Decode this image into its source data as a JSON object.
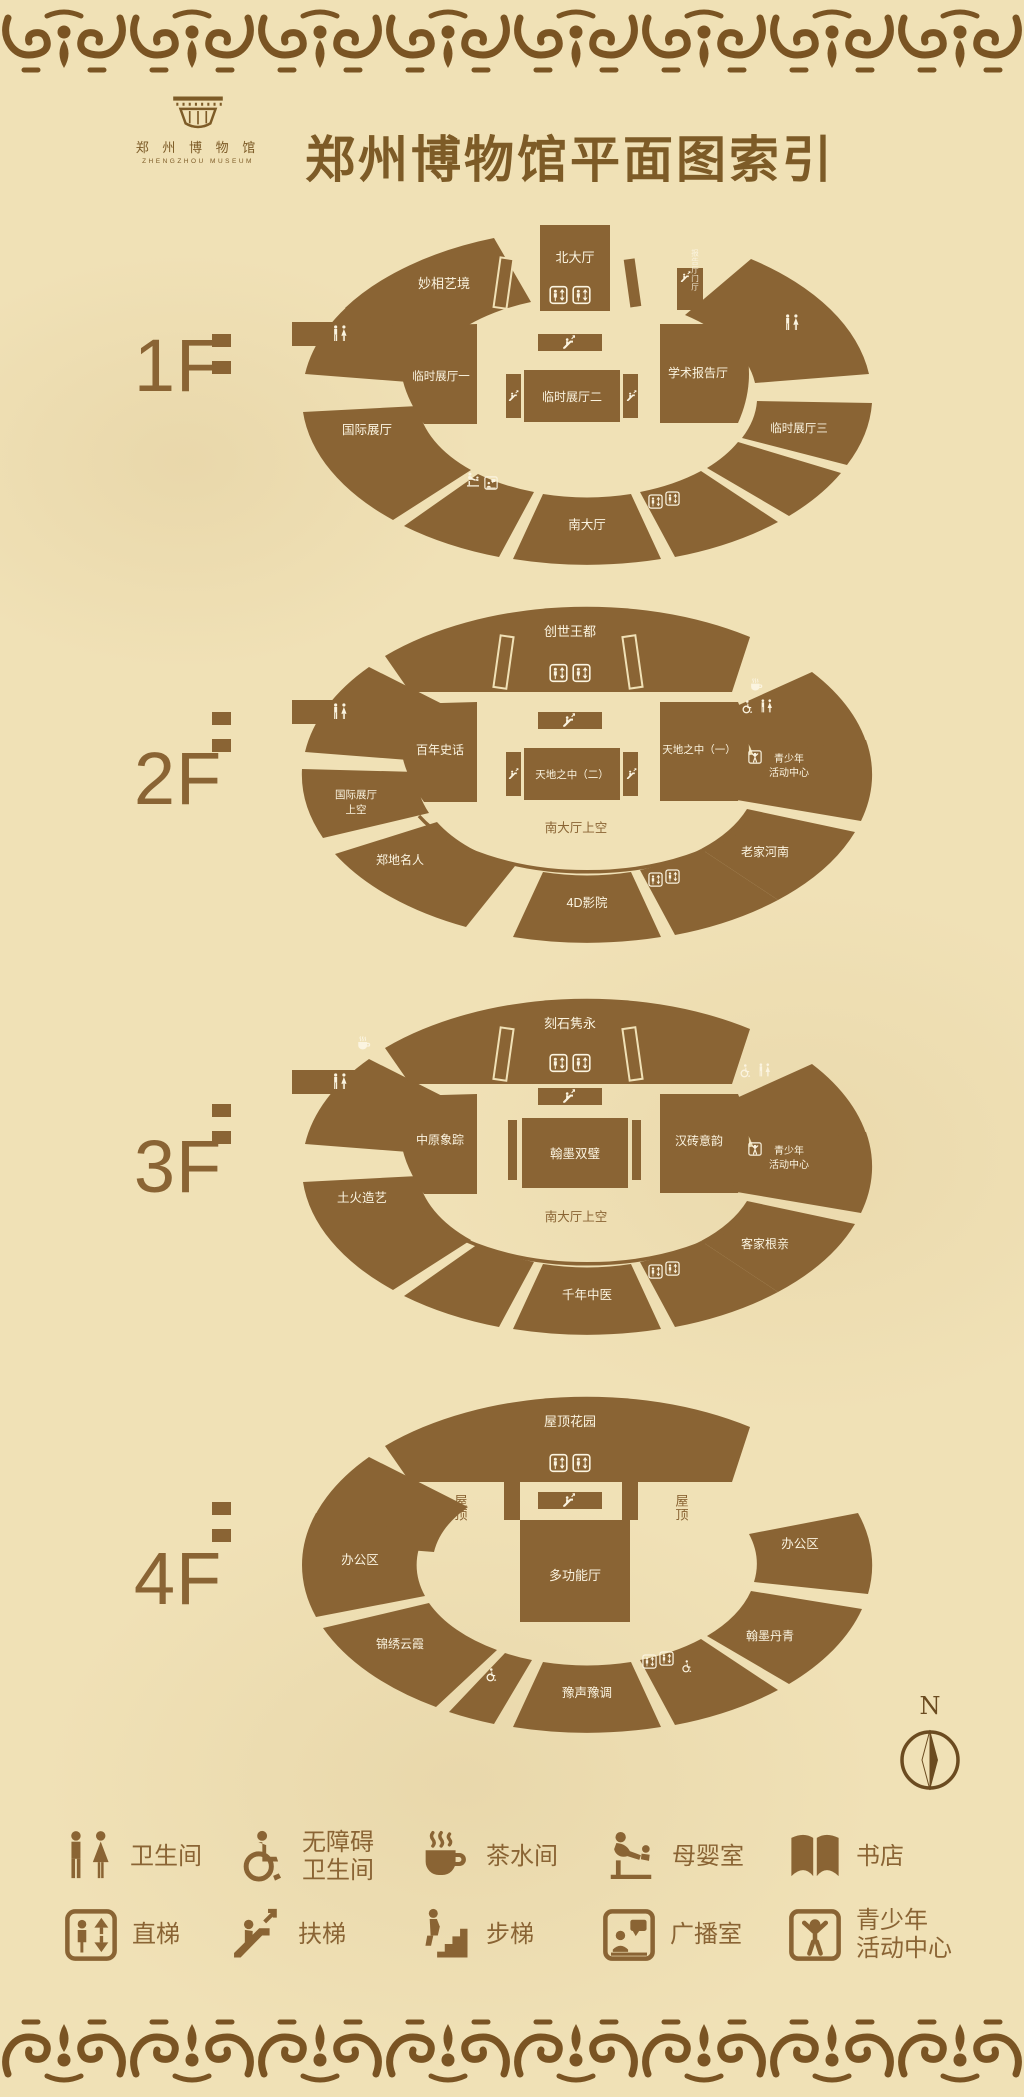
{
  "header": {
    "title": "郑州博物馆平面图索引",
    "logo_cn": "郑 州 博 物 馆",
    "logo_en": "ZHENGZHOU MUSEUM"
  },
  "colors": {
    "paper": "#f0e1b6",
    "plan_brown": "#8a6434",
    "border_brown": "#7a5423",
    "label_cream": "#fbf4e0"
  },
  "floors": [
    {
      "label": "1F",
      "rooms": {
        "top_left": "妙相艺境",
        "north_hall": "北大厅",
        "foyer": "报告厅门厅",
        "lecture": "学术报告厅",
        "temp1": "临时展厅一",
        "temp2": "临时展厅二",
        "temp3": "临时展厅三",
        "intl": "国际展厅",
        "south_hall": "南大厅"
      }
    },
    {
      "label": "2F",
      "rooms": {
        "top": "创世王都",
        "intl_up1": "国际展厅",
        "intl_up2": "上空",
        "century": "百年史话",
        "heaven2": "天地之中（二）",
        "heaven1": "天地之中（一）",
        "youth1": "青少年",
        "youth2": "活动中心",
        "zheng": "郑地名人",
        "south_up": "南大厅上空",
        "laojia": "老家河南",
        "cinema": "4D影院"
      }
    },
    {
      "label": "3F",
      "rooms": {
        "top": "刻石隽永",
        "elephant": "中原象踪",
        "hanmo": "翰墨双璧",
        "hanzhuan": "汉砖意韵",
        "youth1": "青少年",
        "youth2": "活动中心",
        "tuhuo": "土火造艺",
        "south_up": "南大厅上空",
        "kejia": "客家根亲",
        "zhongyi": "千年中医"
      }
    },
    {
      "label": "4F",
      "rooms": {
        "top": "屋顶花园",
        "office_left": "办公区",
        "roof_left": "屋顶",
        "multi": "多功能厅",
        "roof_right": "屋顶",
        "office_right": "办公区",
        "jinxiu": "锦绣云霞",
        "yusheng": "豫声豫调",
        "hanmo": "翰墨丹青"
      }
    }
  ],
  "legend": {
    "row1": [
      {
        "icon": "restroom-icon",
        "label1": "卫生间",
        "label2": ""
      },
      {
        "icon": "accessible-restroom-icon",
        "label1": "无障碍",
        "label2": "卫生间"
      },
      {
        "icon": "tea-room-icon",
        "label1": "茶水间",
        "label2": ""
      },
      {
        "icon": "nursing-room-icon",
        "label1": "母婴室",
        "label2": ""
      },
      {
        "icon": "bookstore-icon",
        "label1": "书店",
        "label2": ""
      }
    ],
    "row2": [
      {
        "icon": "elevator-icon",
        "label1": "直梯",
        "label2": ""
      },
      {
        "icon": "escalator-icon",
        "label1": "扶梯",
        "label2": ""
      },
      {
        "icon": "stairs-icon",
        "label1": "步梯",
        "label2": ""
      },
      {
        "icon": "broadcast-room-icon",
        "label1": "广播室",
        "label2": ""
      },
      {
        "icon": "youth-center-icon",
        "label1": "青少年",
        "label2": "活动中心"
      }
    ]
  },
  "compass": {
    "label": "N"
  }
}
